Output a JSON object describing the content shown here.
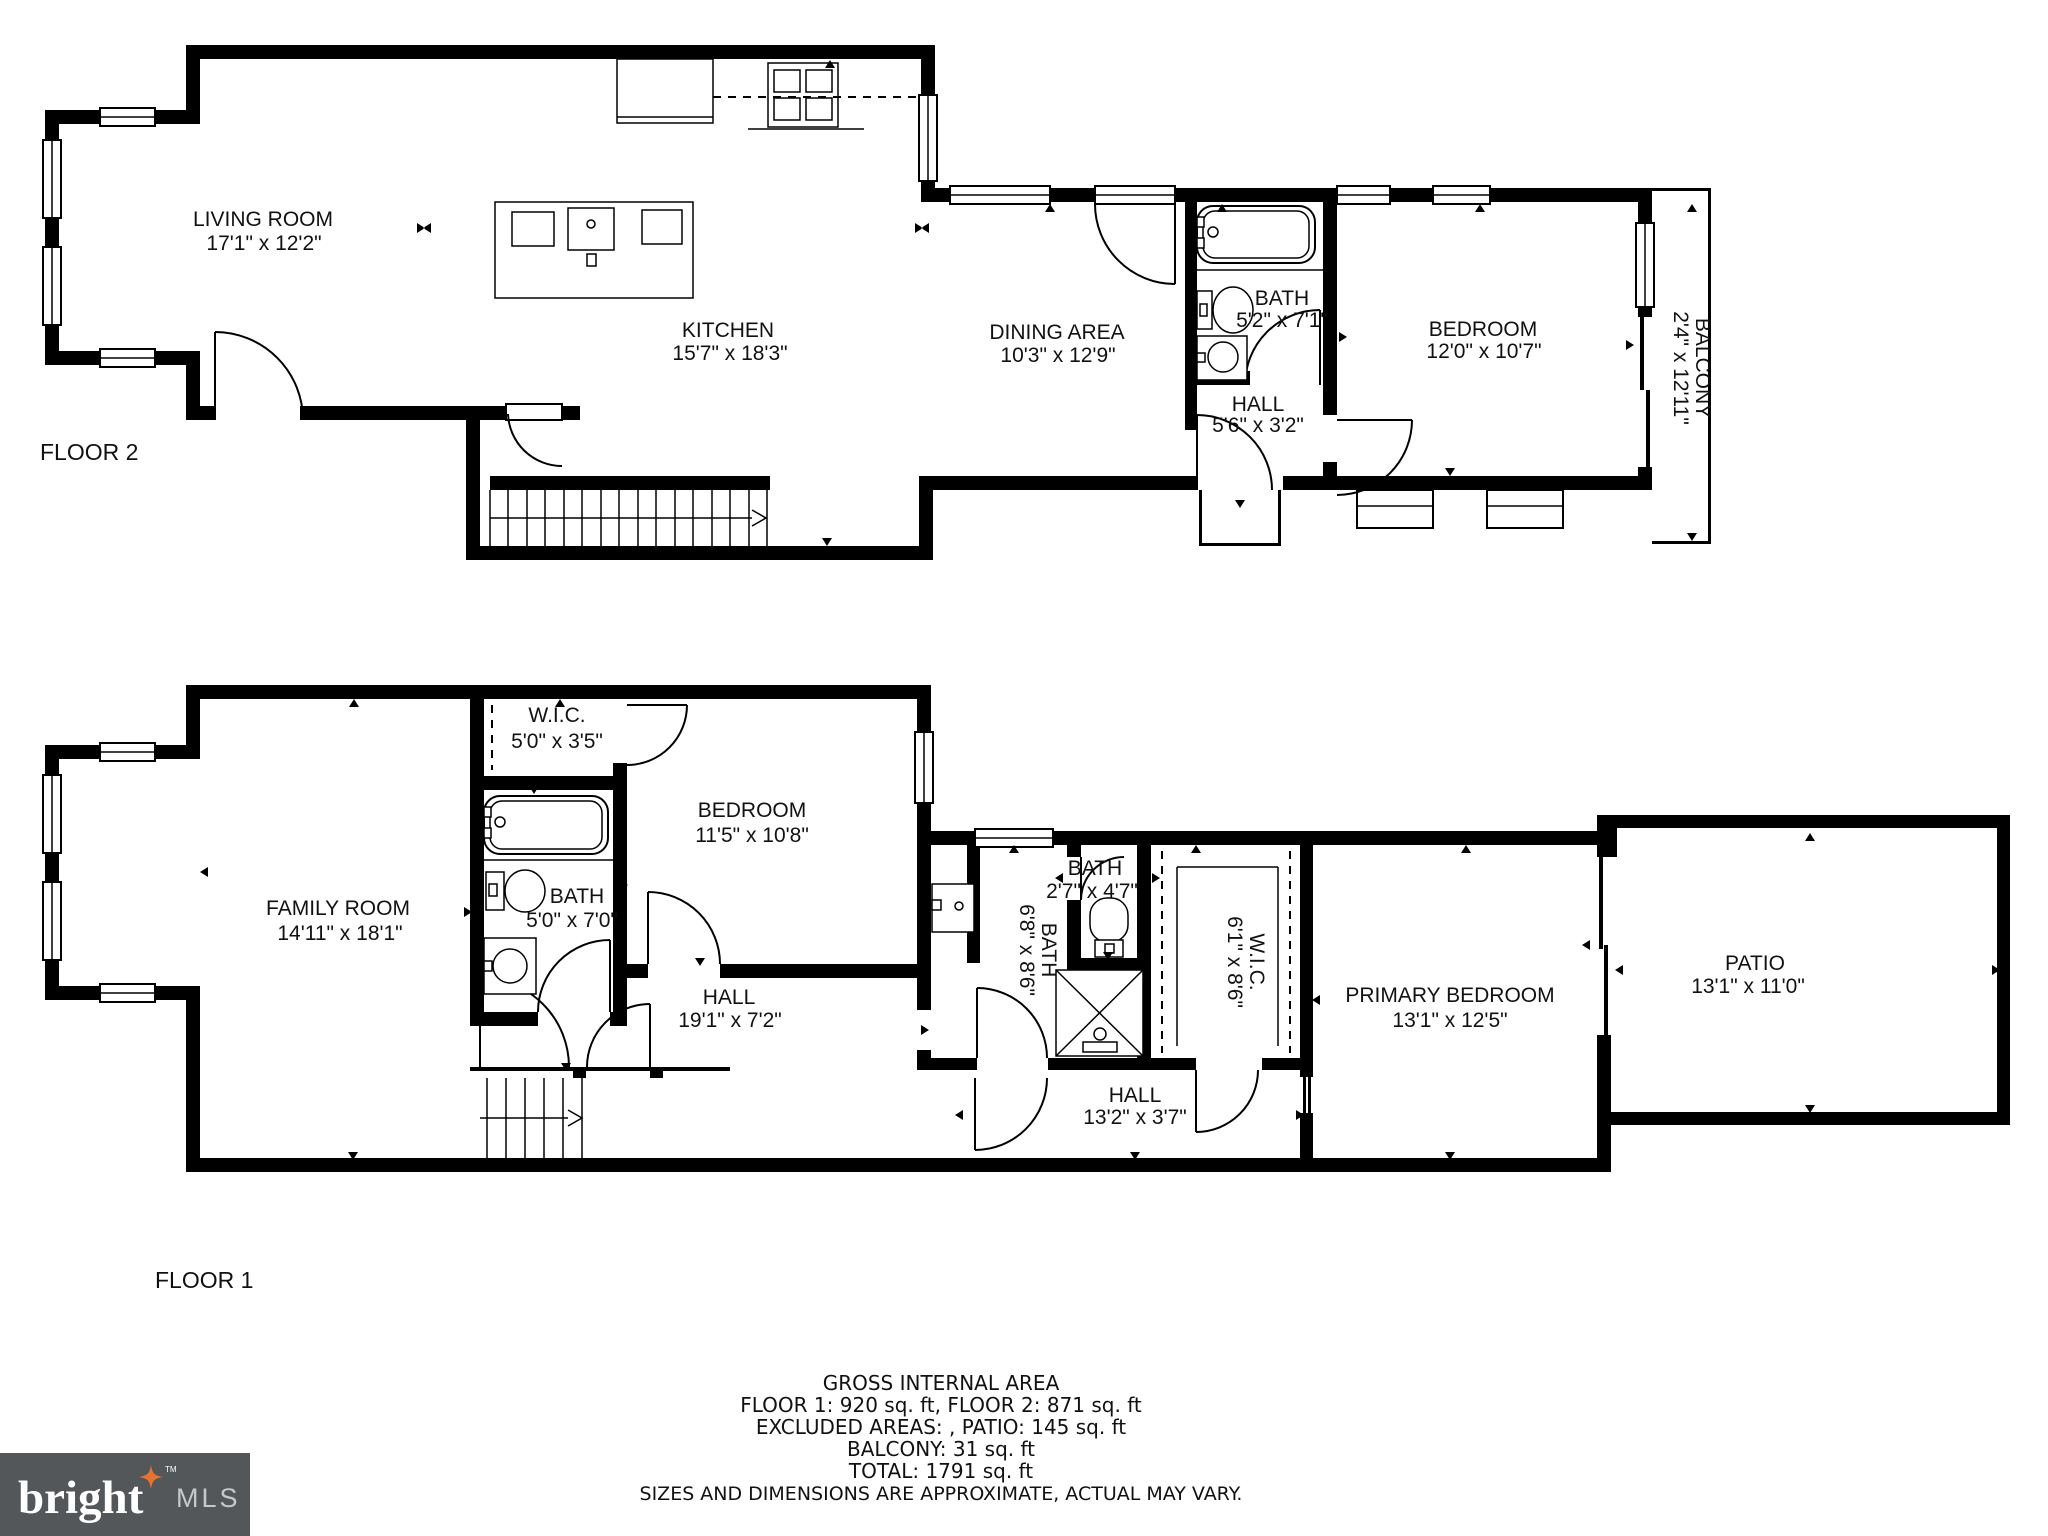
{
  "floor2": {
    "name": "FLOOR 2",
    "rooms": {
      "living": {
        "name": "LIVING ROOM",
        "dims": "17'1\" x 12'2\""
      },
      "kitchen": {
        "name": "KITCHEN",
        "dims": "15'7\" x 18'3\""
      },
      "dining": {
        "name": "DINING AREA",
        "dims": "10'3\" x 12'9\""
      },
      "bath": {
        "name": "BATH",
        "dims": "5'2\" x 7'1\""
      },
      "hall": {
        "name": "HALL",
        "dims": "5'6\" x 3'2\""
      },
      "bedroom": {
        "name": "BEDROOM",
        "dims": "12'0\" x 10'7\""
      },
      "balcony": {
        "name": "BALCONY",
        "dims": "2'4\" x 12'11\""
      }
    }
  },
  "floor1": {
    "name": "FLOOR 1",
    "rooms": {
      "family": {
        "name": "FAMILY ROOM",
        "dims": "14'11\" x 18'1\""
      },
      "wic1": {
        "name": "W.I.C.",
        "dims": "5'0\" x 3'5\""
      },
      "bath1": {
        "name": "BATH",
        "dims": "5'0\" x 7'0\""
      },
      "bedroom": {
        "name": "BEDROOM",
        "dims": "11'5\" x 10'8\""
      },
      "hall1": {
        "name": "HALL",
        "dims": "19'1\" x 7'2\""
      },
      "bathmid": {
        "name": "BATH",
        "dims": "6'8\" x 8'6\""
      },
      "bath3": {
        "name": "BATH",
        "dims": "2'7\" x 4'7\""
      },
      "wic2": {
        "name": "W.I.C.",
        "dims": "6'1\" x 8'6\""
      },
      "hall2": {
        "name": "HALL",
        "dims": "13'2\" x 3'7\""
      },
      "primary": {
        "name": "PRIMARY BEDROOM",
        "dims": "13'1\" x 12'5\""
      },
      "patio": {
        "name": "PATIO",
        "dims": "13'1\" x 11'0\""
      }
    }
  },
  "footer": {
    "title": "GROSS INTERNAL AREA",
    "line1": "FLOOR 1: 920 sq. ft, FLOOR 2: 871 sq. ft",
    "line2": "EXCLUDED AREAS: , PATIO: 145 sq. ft",
    "line3": "BALCONY: 31 sq. ft",
    "line4": "TOTAL: 1791 sq. ft",
    "disclaimer": "SIZES AND DIMENSIONS ARE APPROXIMATE, ACTUAL MAY VARY."
  },
  "logo": {
    "brand": "bright",
    "suffix": "MLS",
    "tm": "TM"
  },
  "colors": {
    "wall": "#000000",
    "background": "#FFFFFF",
    "logo_bg": "#54575A",
    "logo_star": "#E8732F",
    "logo_text": "#FFFFFF",
    "logo_mls": "#C6C9CB"
  }
}
